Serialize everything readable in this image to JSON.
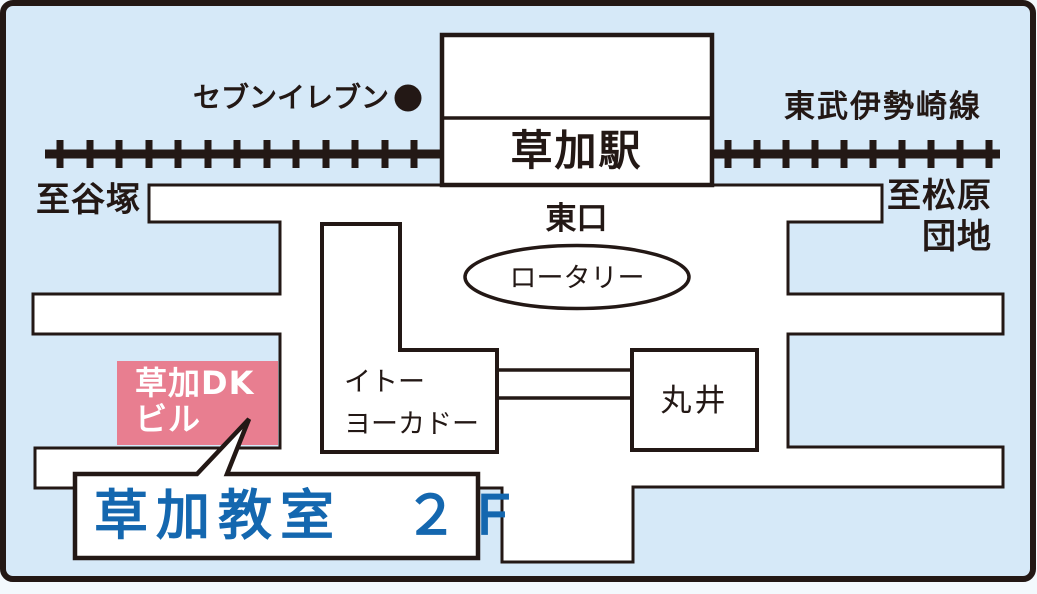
{
  "map": {
    "title": "草加教室への地図",
    "labels": {
      "seven_eleven": "セブンイレブン",
      "railway_line": "東武伊勢崎線",
      "to_yatsuka": "至谷塚",
      "to_matsubara": "至松原\n団地",
      "station": "草加駅",
      "east_exit": "東口",
      "rotary": "ロータリー",
      "ito_yokado": "イトー\nヨーカドー",
      "marui": "丸井",
      "dk_building": "草加DK\nビル",
      "classroom": "草加教室　２Ｆ"
    },
    "icons": {
      "seven_eleven_dot": "location-dot",
      "railway": "railway-track"
    }
  },
  "colors": {
    "background": "#d6e9f8",
    "road": "#ffffff",
    "line": "#231815",
    "building_pink": "#e87e90",
    "classroom_blue": "#1467af",
    "text_black": "#231815",
    "white_text": "#ffffff"
  }
}
